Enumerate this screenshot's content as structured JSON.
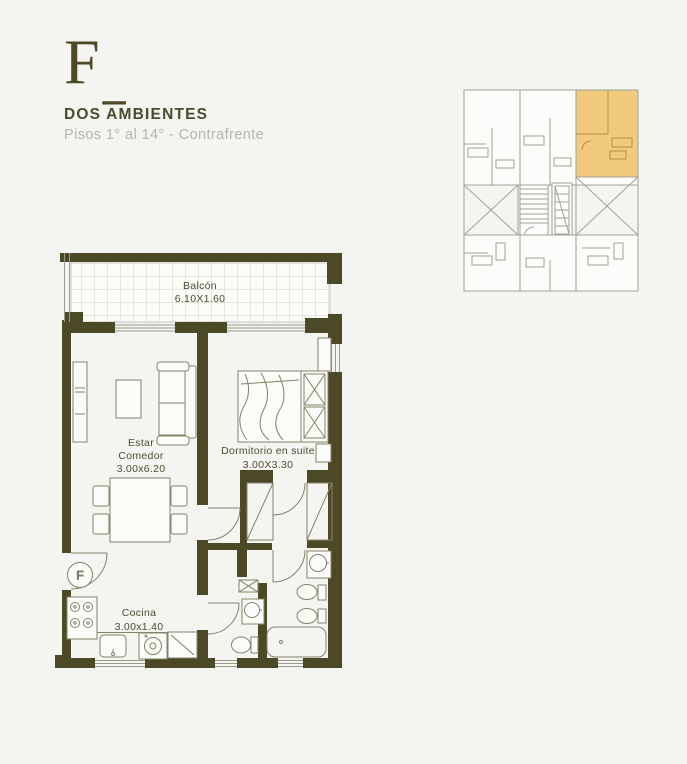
{
  "header": {
    "letter": "F",
    "letter_suffix": "_",
    "title": "DOS AMBIENTES",
    "subtitle": "Pisos 1° al 14° - Contrafrente"
  },
  "plan": {
    "balcony": {
      "name": "Balcón",
      "dims": "6.10X1.60"
    },
    "living": {
      "line1": "Estar",
      "line2": "Comedor",
      "dims": "3.00x6.20"
    },
    "bedroom": {
      "name": "Dormitorio en suite",
      "dims": "3.00X3.30"
    },
    "kitchen": {
      "name": "Cocina",
      "dims": "3.00x1.40"
    },
    "entrance": {
      "label": "F"
    }
  },
  "colors": {
    "background": "#f4f4f1",
    "wall": "#4c4926",
    "furniture_line": "#83836b",
    "label_text": "#4f4c33",
    "title_text": "#4a4a2e",
    "subtitle_text": "#b5b5b0",
    "keyplan_line": "#a2a299",
    "keyplan_highlight": "#f2ca7d"
  }
}
